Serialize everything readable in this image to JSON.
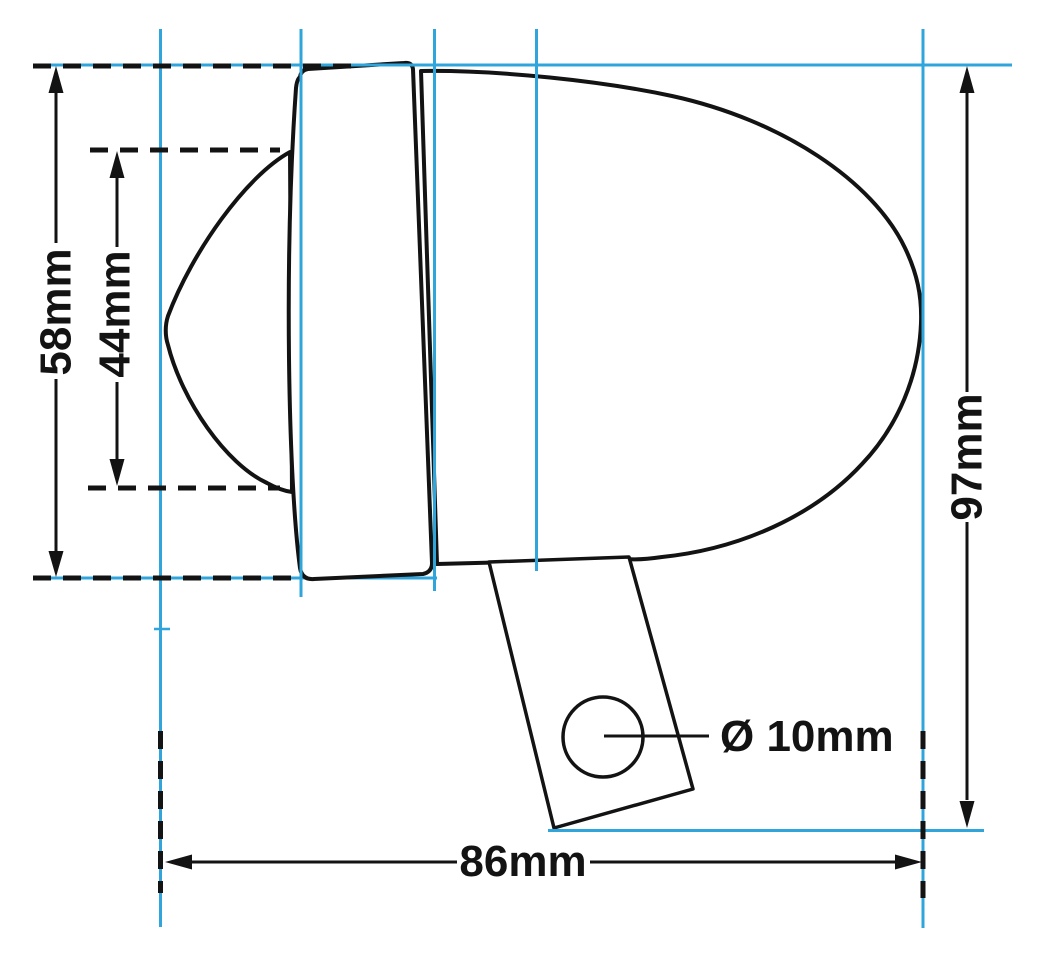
{
  "diagram": {
    "background": "#ffffff",
    "colors": {
      "guide": "#2FA5DC",
      "ink": "#131313"
    },
    "labels": {
      "bezel_height": "58mm",
      "lens_diameter": "44mm",
      "overall_height": "97mm",
      "overall_width": "86mm",
      "hole_diameter": "Ø 10mm"
    }
  }
}
